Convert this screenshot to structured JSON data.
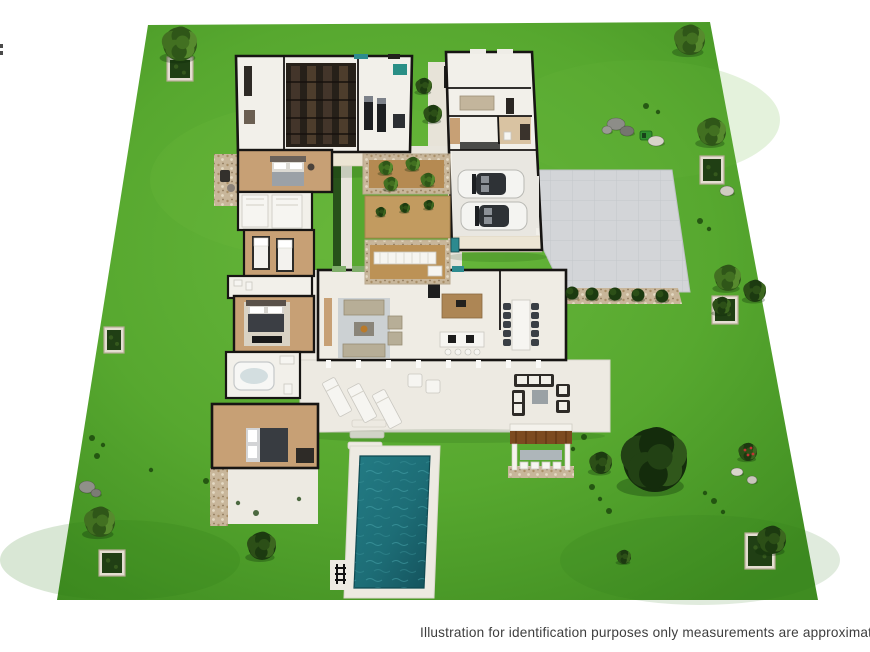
{
  "caption": {
    "text": "Illustration for identification purposes only measurements are approximate"
  },
  "scene": {
    "type": "3d-aerial-floor-plan-illustration",
    "counts": {
      "cars_in_garage": 2,
      "sun_loungers": 3,
      "courtyard_planters": 3,
      "driveway_edge_bushes": 5,
      "stepping_stones": 3,
      "pool_count": 1
    }
  },
  "colors": {
    "grass": "#57a82f",
    "grass_light": "#6ab93d",
    "grass_dark": "#3f8c21",
    "wall": "#171513",
    "floor": "#f2f0ea",
    "wood": "#c7a075",
    "cream": "#ece5d4",
    "drive": "#d3d5d8",
    "gravel": "#c8b69a",
    "deck": "#edeae2",
    "pool": "#1d6d76",
    "pool_deep": "#14525c",
    "ripple": "#48a5ac",
    "rug": "#ccd1d3",
    "sofa": "#b7ae97",
    "pergola": "#7c4a20",
    "car": "#f4f4f1",
    "teal_unit": "#2d8a8f",
    "soil": "#b58a52",
    "caption": "#3e3e3e"
  },
  "vegetation": {
    "trees": [
      {
        "x": 180,
        "y": 44,
        "r": 17,
        "tone": "mid",
        "name": "tree-top-left"
      },
      {
        "x": 690,
        "y": 40,
        "r": 15,
        "tone": "mid",
        "name": "tree-top-right"
      },
      {
        "x": 712,
        "y": 132,
        "r": 14,
        "tone": "mid",
        "name": "tree-right-upper"
      },
      {
        "x": 728,
        "y": 278,
        "r": 13,
        "tone": "mid",
        "name": "tree-right-mid-1"
      },
      {
        "x": 755,
        "y": 291,
        "r": 11,
        "tone": "dark",
        "name": "tree-right-mid-2"
      },
      {
        "x": 655,
        "y": 460,
        "r": 32,
        "tone": "palm",
        "name": "large-palm-tree"
      },
      {
        "x": 601,
        "y": 463,
        "r": 11,
        "tone": "dark",
        "name": "shrub-left-of-palm"
      },
      {
        "x": 100,
        "y": 522,
        "r": 15,
        "tone": "mid",
        "name": "tree-bottom-left"
      },
      {
        "x": 262,
        "y": 546,
        "r": 14,
        "tone": "dark",
        "name": "tree-bottom-center"
      },
      {
        "x": 624,
        "y": 557,
        "r": 7,
        "tone": "dark",
        "name": "small-plant-bottom"
      },
      {
        "x": 748,
        "y": 452,
        "r": 9,
        "tone": "dark",
        "flowers": true,
        "name": "flowering-shrub"
      },
      {
        "x": 722,
        "y": 306,
        "r": 9,
        "tone": "dark",
        "name": "planter-bush-right"
      },
      {
        "x": 772,
        "y": 540,
        "r": 14,
        "tone": "dark",
        "name": "planter-bush-bottom-right"
      },
      {
        "x": 424,
        "y": 86,
        "r": 8,
        "tone": "dark",
        "name": "entry-hedge-1"
      },
      {
        "x": 433,
        "y": 114,
        "r": 9,
        "tone": "dark",
        "name": "entry-hedge-2"
      },
      {
        "x": 386,
        "y": 168,
        "r": 7,
        "tone": "mid",
        "name": "courtyard-bush-1"
      },
      {
        "x": 413,
        "y": 164,
        "r": 7,
        "tone": "mid",
        "name": "courtyard-bush-2"
      },
      {
        "x": 391,
        "y": 184,
        "r": 7,
        "tone": "mid",
        "name": "courtyard-bush-3"
      },
      {
        "x": 428,
        "y": 180,
        "r": 7,
        "tone": "mid",
        "name": "courtyard-bush-4"
      },
      {
        "x": 381,
        "y": 212,
        "r": 5,
        "tone": "dark",
        "name": "olive-tree-1"
      },
      {
        "x": 405,
        "y": 208,
        "r": 5,
        "tone": "dark",
        "name": "olive-tree-2"
      },
      {
        "x": 429,
        "y": 205,
        "r": 5,
        "tone": "dark",
        "name": "olive-tree-3"
      }
    ],
    "driveway_bushes": [
      [
        572,
        293
      ],
      [
        592,
        294
      ],
      [
        615,
        294
      ],
      [
        638,
        295
      ],
      [
        662,
        296
      ]
    ],
    "tufts": [
      [
        92,
        438
      ],
      [
        103,
        445
      ],
      [
        97,
        456
      ],
      [
        151,
        470
      ],
      [
        206,
        481
      ],
      [
        238,
        503
      ],
      [
        256,
        513
      ],
      [
        299,
        499
      ],
      [
        584,
        437
      ],
      [
        573,
        449
      ],
      [
        592,
        487
      ],
      [
        600,
        499
      ],
      [
        609,
        511
      ],
      [
        705,
        493
      ],
      [
        714,
        501
      ],
      [
        723,
        512
      ],
      [
        700,
        221
      ],
      [
        709,
        229
      ],
      [
        646,
        106
      ],
      [
        658,
        112
      ]
    ],
    "rocks": [
      {
        "x": 616,
        "y": 124,
        "rx": 9,
        "ry": 6,
        "fill": "#8d8d88"
      },
      {
        "x": 627,
        "y": 131,
        "rx": 7,
        "ry": 5,
        "fill": "#75756f"
      },
      {
        "x": 607,
        "y": 130,
        "rx": 5,
        "ry": 4,
        "fill": "#9a9a94"
      },
      {
        "x": 656,
        "y": 141,
        "rx": 8,
        "ry": 5,
        "fill": "#d7d3c9"
      },
      {
        "x": 727,
        "y": 191,
        "rx": 7,
        "ry": 5,
        "fill": "#cfccc1"
      },
      {
        "x": 87,
        "y": 487,
        "rx": 8,
        "ry": 6,
        "fill": "#8f9089"
      },
      {
        "x": 96,
        "y": 493,
        "rx": 5,
        "ry": 4,
        "fill": "#7b7c75"
      },
      {
        "x": 737,
        "y": 472,
        "rx": 6,
        "ry": 4,
        "fill": "#d8d5cb"
      },
      {
        "x": 752,
        "y": 480,
        "rx": 5,
        "ry": 4,
        "fill": "#c9c6bb"
      }
    ],
    "planter_boxes": [
      {
        "x": 167,
        "y": 57,
        "w": 26,
        "h": 24,
        "name": "hedge-planter-top-left"
      },
      {
        "x": 700,
        "y": 156,
        "w": 24,
        "h": 28,
        "name": "hedge-planter-right-upper"
      },
      {
        "x": 104,
        "y": 327,
        "w": 20,
        "h": 26,
        "name": "hedge-planter-left"
      },
      {
        "x": 712,
        "y": 296,
        "w": 26,
        "h": 28,
        "name": "hedge-planter-right-mid"
      },
      {
        "x": 99,
        "y": 550,
        "w": 26,
        "h": 26,
        "name": "hedge-planter-bottom-left"
      },
      {
        "x": 745,
        "y": 533,
        "w": 30,
        "h": 36,
        "name": "hedge-planter-bottom-right"
      }
    ]
  }
}
